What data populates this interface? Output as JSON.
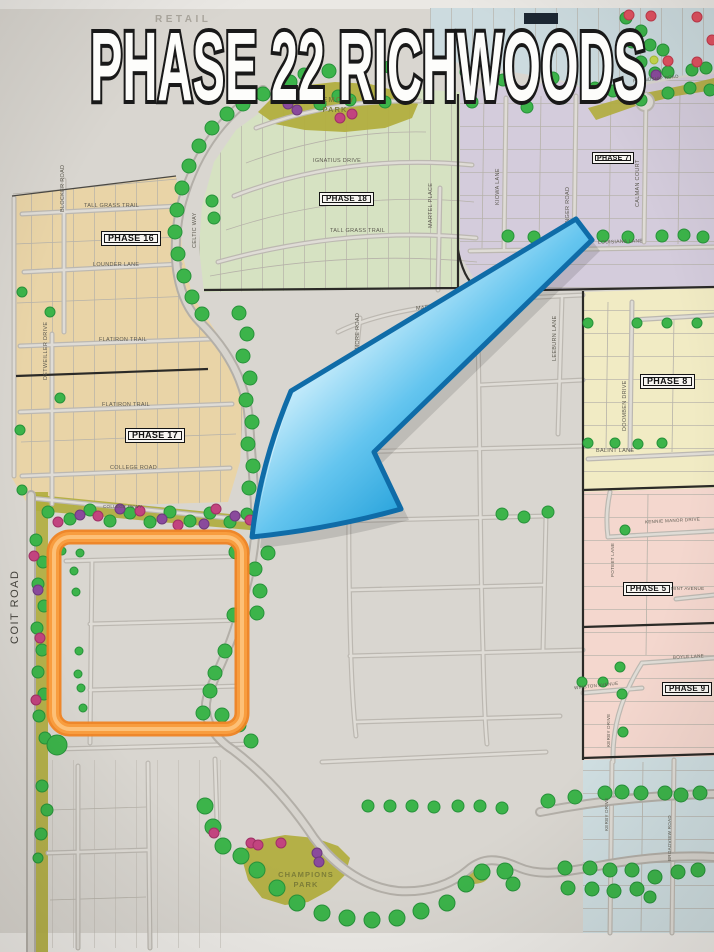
{
  "title": "PHASE 22 RICHWOODS",
  "map": {
    "retail_label": "RETAIL",
    "parks": {
      "memory_line1": "MEMORY",
      "memory_line2": "PARK",
      "champions_line1": "CHAMPIONS",
      "champions_line2": "PARK"
    },
    "phases": {
      "p5": "PHASE 5",
      "p7": "PHASE 7",
      "p8": "PHASE 8",
      "p9": "PHASE 9",
      "p16": "PHASE 16",
      "p17": "PHASE 17",
      "p18": "PHASE 18"
    },
    "streets": {
      "coit_road": "COIT ROAD",
      "college_pkwy": "COLLEGE PKWY",
      "college_road": "COLLEGE ROAD",
      "tall_grass_trail": "TALL GRASS TRAIL",
      "lounder_lane": "LOUNDER LANE",
      "blocker_road": "BLOCKER ROAD",
      "celtic_way": "CELTIC WAY",
      "flatiron_trail": "FLATIRON TRAIL",
      "detweiller_drive": "DETWEILLER DRIVE",
      "ignatius_drive": "IGNATIUS DRIVE",
      "martel_place": "MARTEL PLACE",
      "friendship_road": "FRIENDSHIP ROAD",
      "louisiana_lane": "LOUISIANA LANE",
      "kiowa_lane": "KIOWA LANE",
      "ranger_road": "RANGER ROAD",
      "calman_court": "CALMAN COURT",
      "mardi_gras_lane": "MARDI GRAS LANE",
      "ardmore_road": "ARDMORE ROAD",
      "leeburn_lane": "LEEBURN LANE",
      "doomben_drive": "DOOMBEN DRIVE",
      "balint_lane": "BALINT LANE",
      "kennie_manor_drive": "KENNIE MANOR DRIVE",
      "poteet_lane": "POTEET LANE",
      "mint_avenue": "MINT AVENUE",
      "boyle_lane": "BOYLE LANE",
      "winston_avenue": "WINSTON AVENUE",
      "kerby_drive": "KERBY DRIVE",
      "broadview_road": "BROADVIEW ROAD"
    },
    "annotations": {
      "highlight_color": "#F78D2B",
      "arrow_color": "#2FA8E2"
    },
    "region_colors": {
      "phase_16_17": "#E9D4A7",
      "phase_18": "#D6E2C2",
      "phase_7": "#D4CCDC",
      "phase_8": "#F1EBC4",
      "phase_5_9": "#F4D7CE",
      "bottom_right_blue": "#CFDEE1",
      "parks_olive": "#B2AE3F",
      "tree_green": "#3CB44A",
      "tree_purple": "#8A4A9C",
      "tree_magenta": "#C2447F",
      "tree_red": "#E05160"
    }
  }
}
